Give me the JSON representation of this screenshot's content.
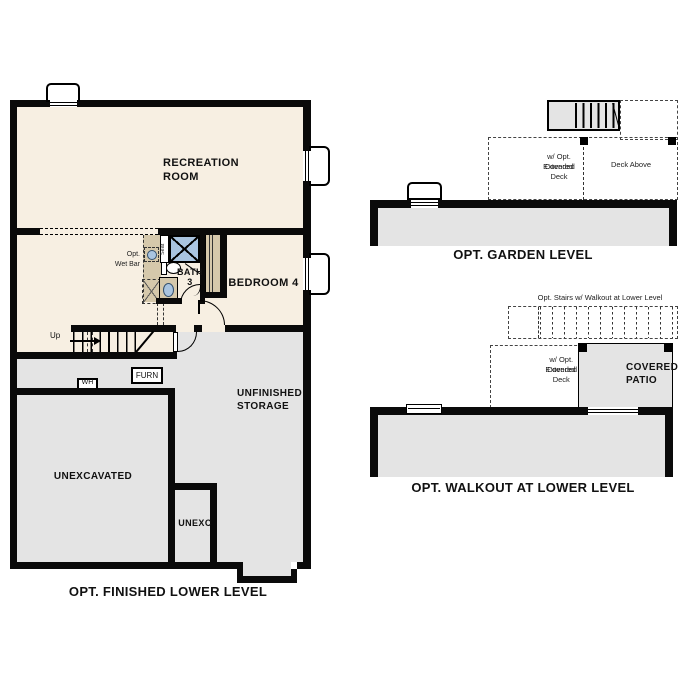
{
  "colors": {
    "cream": "#f7efe2",
    "gray": "#e4e4e4",
    "tan": "#d5c8ab",
    "shower_blue": "#a9c4e0",
    "wall": "#0a0a0a"
  },
  "plans": {
    "lower": {
      "caption": "OPT. FINISHED LOWER LEVEL",
      "recreation": [
        "RECREATION",
        "ROOM"
      ],
      "bedroom4": "BEDROOM 4",
      "bath": "BATH",
      "bath_number": "3",
      "seat": "Seat",
      "wet_bar": [
        "Opt.",
        "Wet Bar"
      ],
      "up": "Up",
      "wh": "WH",
      "furn": "FURN",
      "unfinished_storage": [
        "UNFINISHED",
        "STORAGE"
      ],
      "unexcavated": "UNEXCAVATED",
      "unexc": "UNEXC"
    },
    "garden": {
      "caption": "OPT. GARDEN LEVEL",
      "extended_deck": [
        "w/ Opt. Extended",
        "Covered Deck"
      ],
      "deck_above": "Deck Above"
    },
    "walkout": {
      "caption": "OPT. WALKOUT AT LOWER LEVEL",
      "opt_stairs": "Opt. Stairs w/ Walkout at Lower Level",
      "extended_deck": [
        "w/ Opt. Extended",
        "Covered Deck"
      ],
      "covered_patio": [
        "COVERED",
        "PATIO"
      ]
    }
  }
}
